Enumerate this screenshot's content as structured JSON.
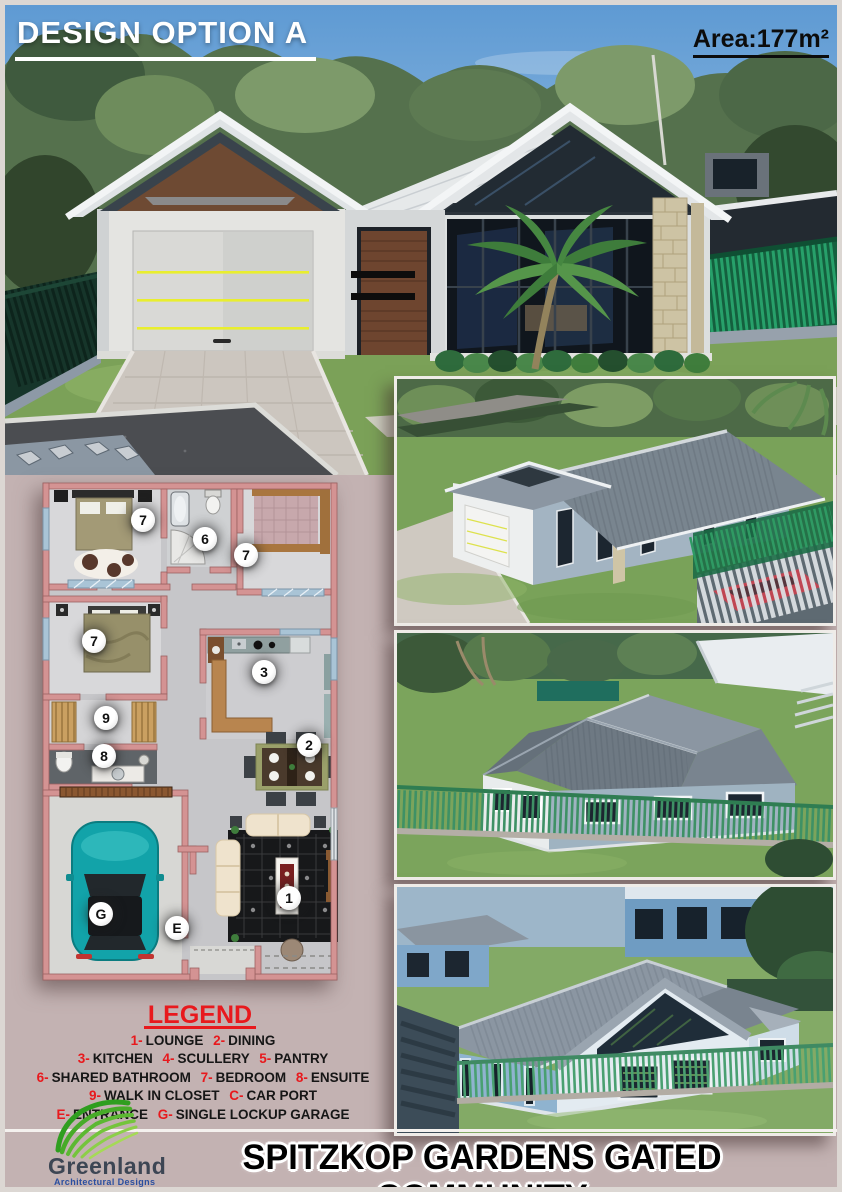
{
  "poster": {
    "title": "DESIGN OPTION A",
    "area_label": "Area:177m²",
    "footer_title": "SPITZKOP GARDENS GATED COMMUNITY"
  },
  "logo": {
    "name": "Greenland",
    "subtitle": "Architectural Designs"
  },
  "legend": {
    "title": "LEGEND",
    "entries": [
      {
        "key": "1-",
        "label": "LOUNGE"
      },
      {
        "key": "2-",
        "label": "DINING"
      },
      {
        "key": "3-",
        "label": "KITCHEN"
      },
      {
        "key": "4-",
        "label": "SCULLERY"
      },
      {
        "key": "5-",
        "label": "PANTRY"
      },
      {
        "key": "6-",
        "label": "SHARED BATHROOM"
      },
      {
        "key": "7-",
        "label": "BEDROOM"
      },
      {
        "key": "8-",
        "label": "ENSUITE"
      },
      {
        "key": "9-",
        "label": "WALK IN CLOSET"
      },
      {
        "key": "C-",
        "label": "CAR PORT"
      },
      {
        "key": "E-",
        "label": "ENTRANCE"
      },
      {
        "key": "G-",
        "label": "SINGLE LOCKUP GARAGE"
      }
    ]
  },
  "floorplan": {
    "markers": [
      {
        "label": "7"
      },
      {
        "label": "6"
      },
      {
        "label": "7"
      },
      {
        "label": "7"
      },
      {
        "label": "3"
      },
      {
        "label": "9"
      },
      {
        "label": "8"
      },
      {
        "label": "2"
      },
      {
        "label": "1"
      },
      {
        "label": "G"
      },
      {
        "label": "E"
      }
    ]
  },
  "colors": {
    "background_mauve": "#c3b2b2",
    "accent_red": "#e8191d",
    "wall_salmon": "#d49393",
    "fence_green": "#1f8a58",
    "roof_gray": "#79858f",
    "car_teal": "#12a3a9",
    "logo_green": "#47ab28",
    "logo_blue": "#2b4fa0"
  }
}
